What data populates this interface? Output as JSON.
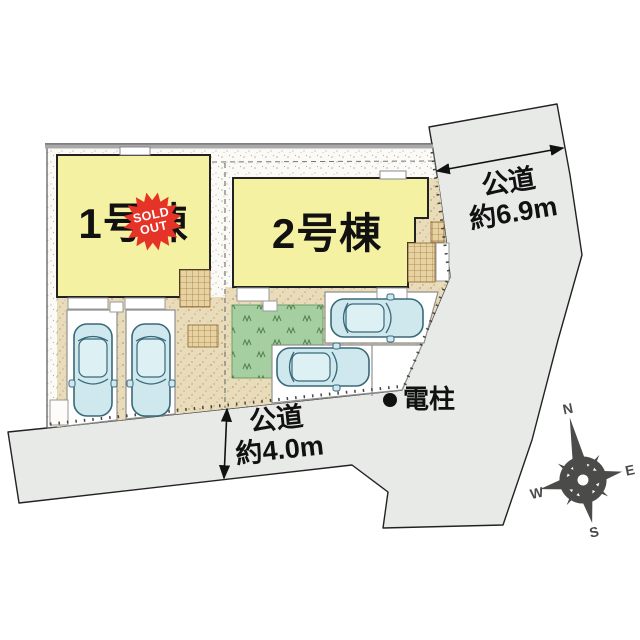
{
  "plan": {
    "building1": {
      "label": "1号棟",
      "badge_line1": "SOLD",
      "badge_line2": "OUT"
    },
    "building2": {
      "label": "2号棟"
    },
    "road_right": {
      "name_line": "公道",
      "width_line": "約6.9m"
    },
    "road_bottom": {
      "name_line": "公道",
      "width_line": "約4.0m"
    },
    "utility_pole": {
      "label": "電柱"
    },
    "compass": {
      "north": "N",
      "south": "S",
      "east": "E",
      "west": "W"
    },
    "colors": {
      "building_fill": "#f5f1a2",
      "road_fill": "#e8eae8",
      "yard_tan": "#e9dcba",
      "green_fill": "#a5cfa0",
      "car_fill": "#cfe8ed",
      "badge_red": "#e63327",
      "compass_gray": "#4b4b49"
    }
  }
}
